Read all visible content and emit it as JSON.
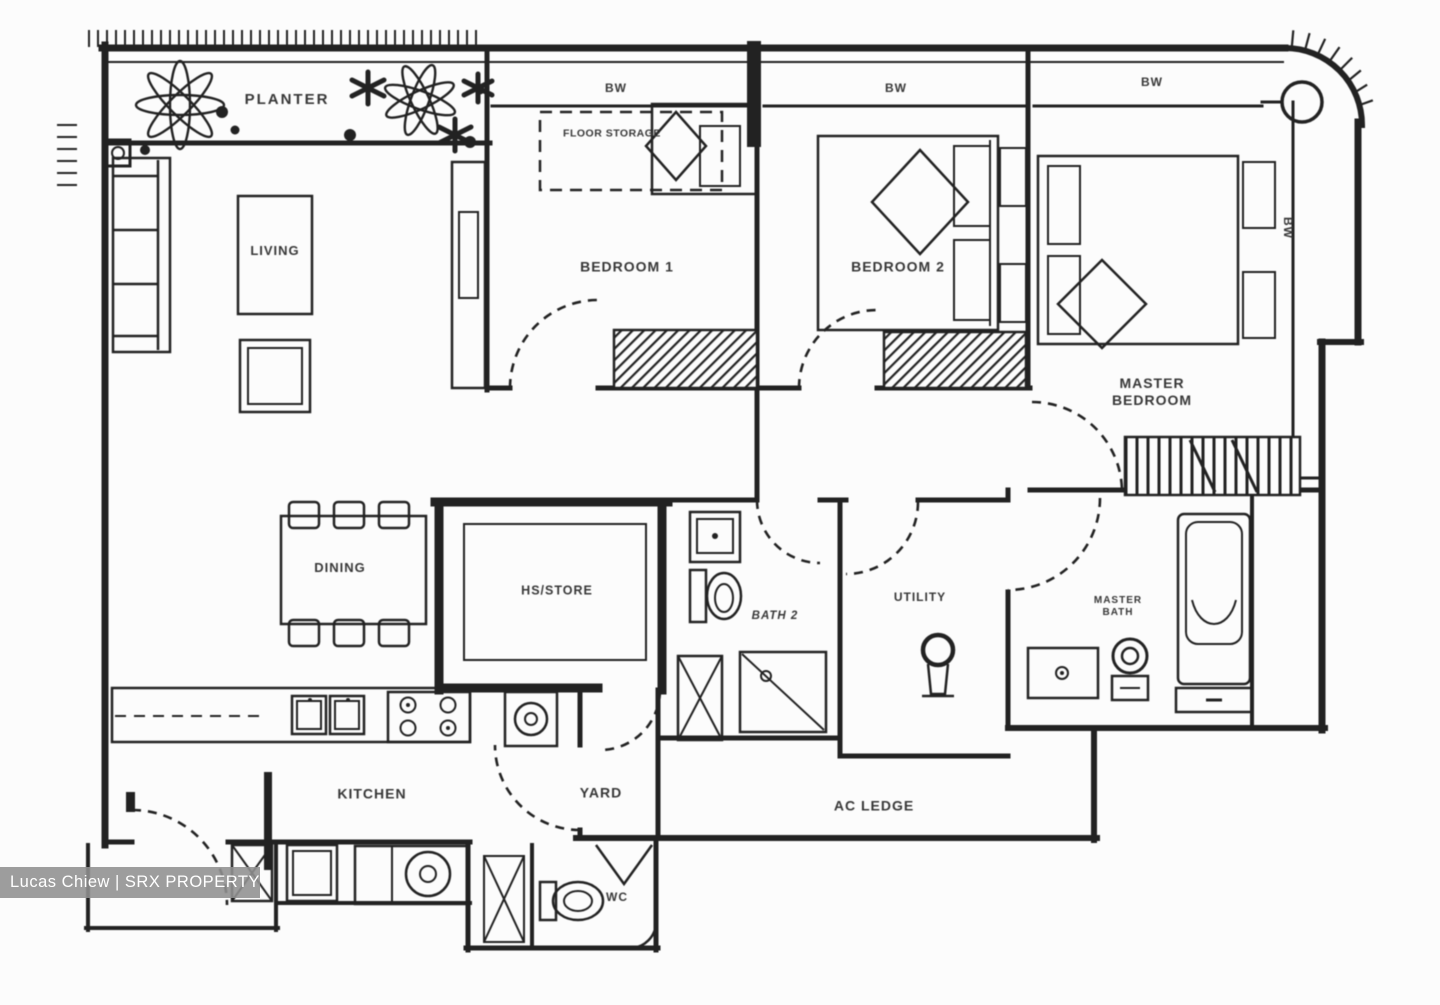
{
  "image_type": "floor-plan",
  "rooms": {
    "planter": "PLANTER",
    "living": "LIVING",
    "dining": "DINING",
    "bedroom1": "BEDROOM 1",
    "bedroom2": "BEDROOM 2",
    "master_bedroom": "MASTER BEDROOM",
    "floor_storage": "FLOOR STORAGE",
    "hs_store": "HS/STORE",
    "bath2": "BATH 2",
    "utility": "UTILITY",
    "master_bath": "MASTER BATH",
    "kitchen": "KITCHEN",
    "yard": "YARD",
    "ac_ledge": "AC LEDGE",
    "wc": "WC",
    "bay_window": "BW"
  },
  "watermark": {
    "text": "Lucas Chiew | SRX PROPERTY"
  },
  "colors": {
    "line": "#222222",
    "label": "#373737",
    "background": "#fcfcfc",
    "watermark_bg": "#8f8f8f",
    "watermark_text": "#ffffff"
  }
}
